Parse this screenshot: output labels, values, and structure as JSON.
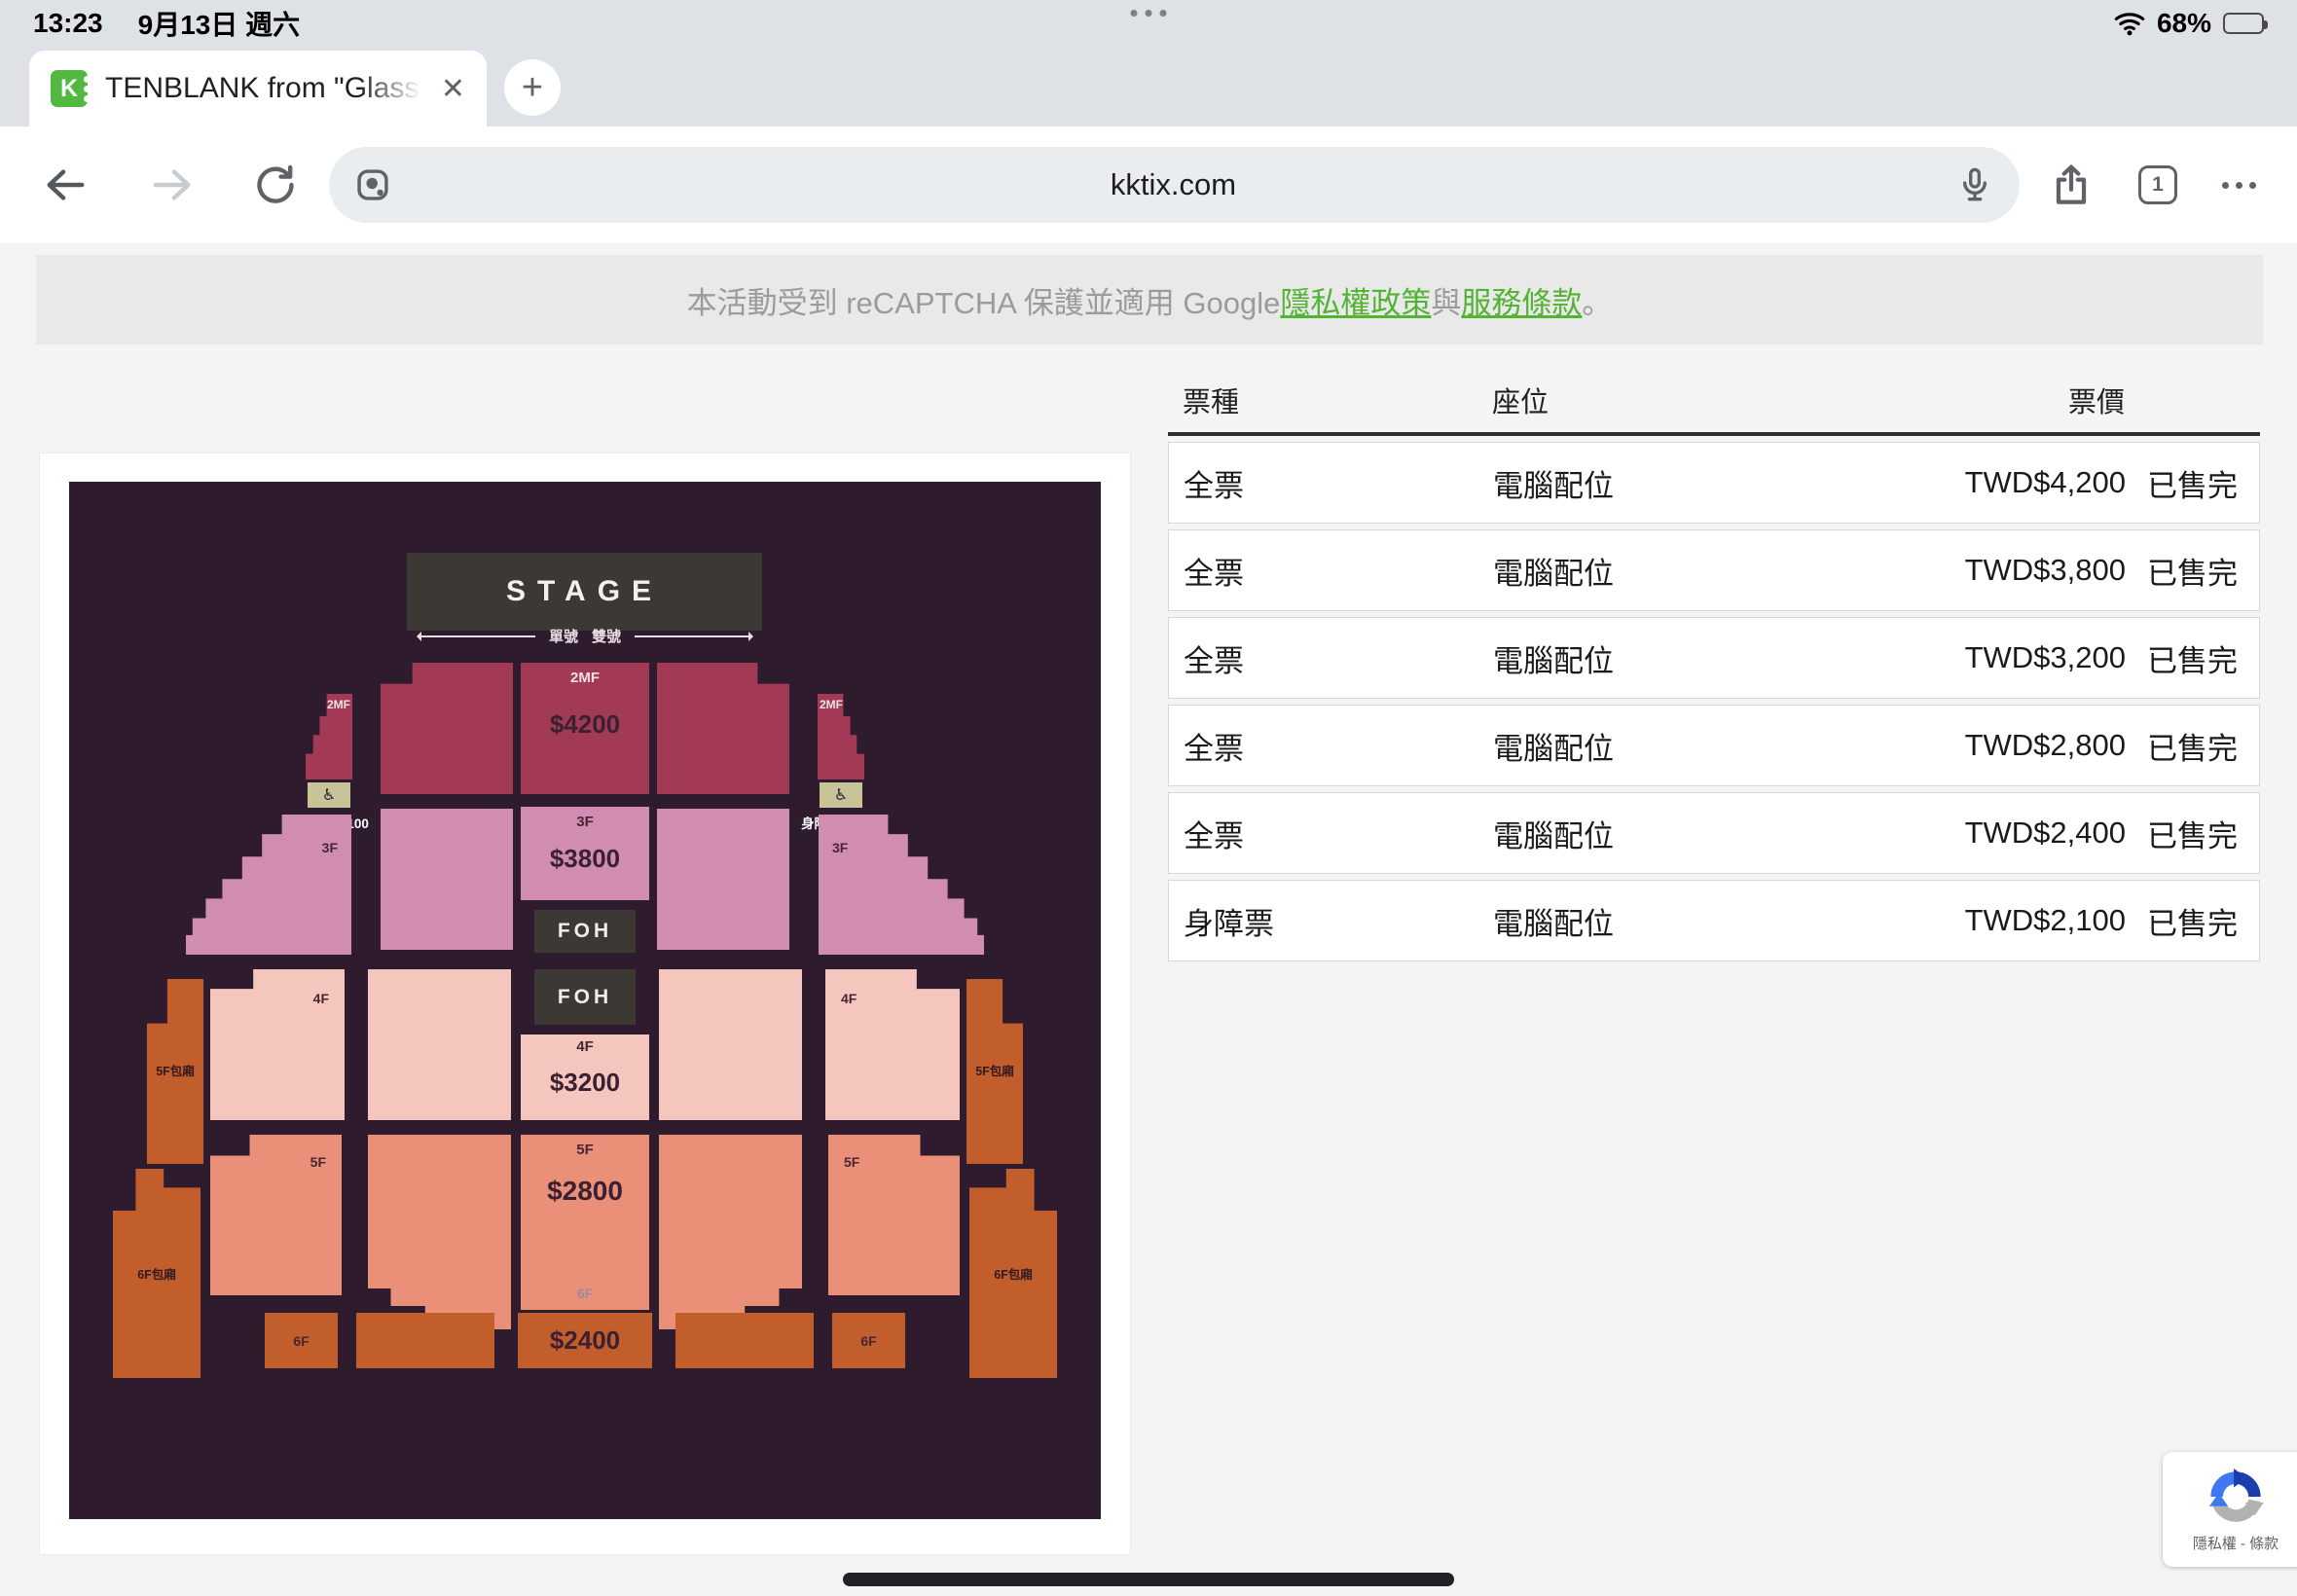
{
  "status_bar": {
    "time": "13:23",
    "date": "9月13日 週六",
    "battery_percent": "68%"
  },
  "browser": {
    "tab_title": "TENBLANK from \"Glass",
    "close_label": "✕",
    "new_tab_label": "+",
    "url": "kktix.com",
    "tab_count": "1"
  },
  "notice": {
    "prefix": "本活動受到 reCAPTCHA 保護並適用 Google ",
    "privacy_link": "隱私權政策",
    "conjunction": " 與 ",
    "terms_link": "服務條款",
    "suffix": "。"
  },
  "seatmap": {
    "stage": "STAGE",
    "odd_label": "單號",
    "even_label": "雙號",
    "sections": {
      "s2mf": {
        "label": "2MF",
        "price": "$4200"
      },
      "s3f": {
        "label": "3F",
        "price": "$3800"
      },
      "foh": "FOH",
      "s4f": {
        "label": "4F",
        "price": "$3200"
      },
      "s5f": {
        "label": "5F",
        "price": "$2800"
      },
      "s6f": {
        "label": "6F",
        "price": "$2400"
      },
      "disabled": {
        "label": "身障席",
        "price": "$2100",
        "icon": "♿"
      },
      "box5f": "5F包廂",
      "box6f": "6F包廂"
    },
    "colors": {
      "bg": "#2e1b2d",
      "stage": "#3c3935",
      "s2mf": "#a23a55",
      "s3f": "#d18cb2",
      "s4f": "#f4c6bd",
      "s5f": "#ea9078",
      "s6f": "#c25d2c",
      "wheelchair_box": "#c9c398"
    }
  },
  "ticket_table": {
    "headers": [
      "票種",
      "座位",
      "票價"
    ],
    "rows": [
      {
        "type": "全票",
        "seat": "電腦配位",
        "price": "TWD$4,200",
        "status": "已售完"
      },
      {
        "type": "全票",
        "seat": "電腦配位",
        "price": "TWD$3,800",
        "status": "已售完"
      },
      {
        "type": "全票",
        "seat": "電腦配位",
        "price": "TWD$3,200",
        "status": "已售完"
      },
      {
        "type": "全票",
        "seat": "電腦配位",
        "price": "TWD$2,800",
        "status": "已售完"
      },
      {
        "type": "全票",
        "seat": "電腦配位",
        "price": "TWD$2,400",
        "status": "已售完"
      },
      {
        "type": "身障票",
        "seat": "電腦配位",
        "price": "TWD$2,100",
        "status": "已售完"
      }
    ]
  },
  "recaptcha_badge": {
    "label": "隱私權 - 條款"
  },
  "accent_colors": {
    "link_green": "#53b332",
    "favicon_green": "#53b83f"
  }
}
